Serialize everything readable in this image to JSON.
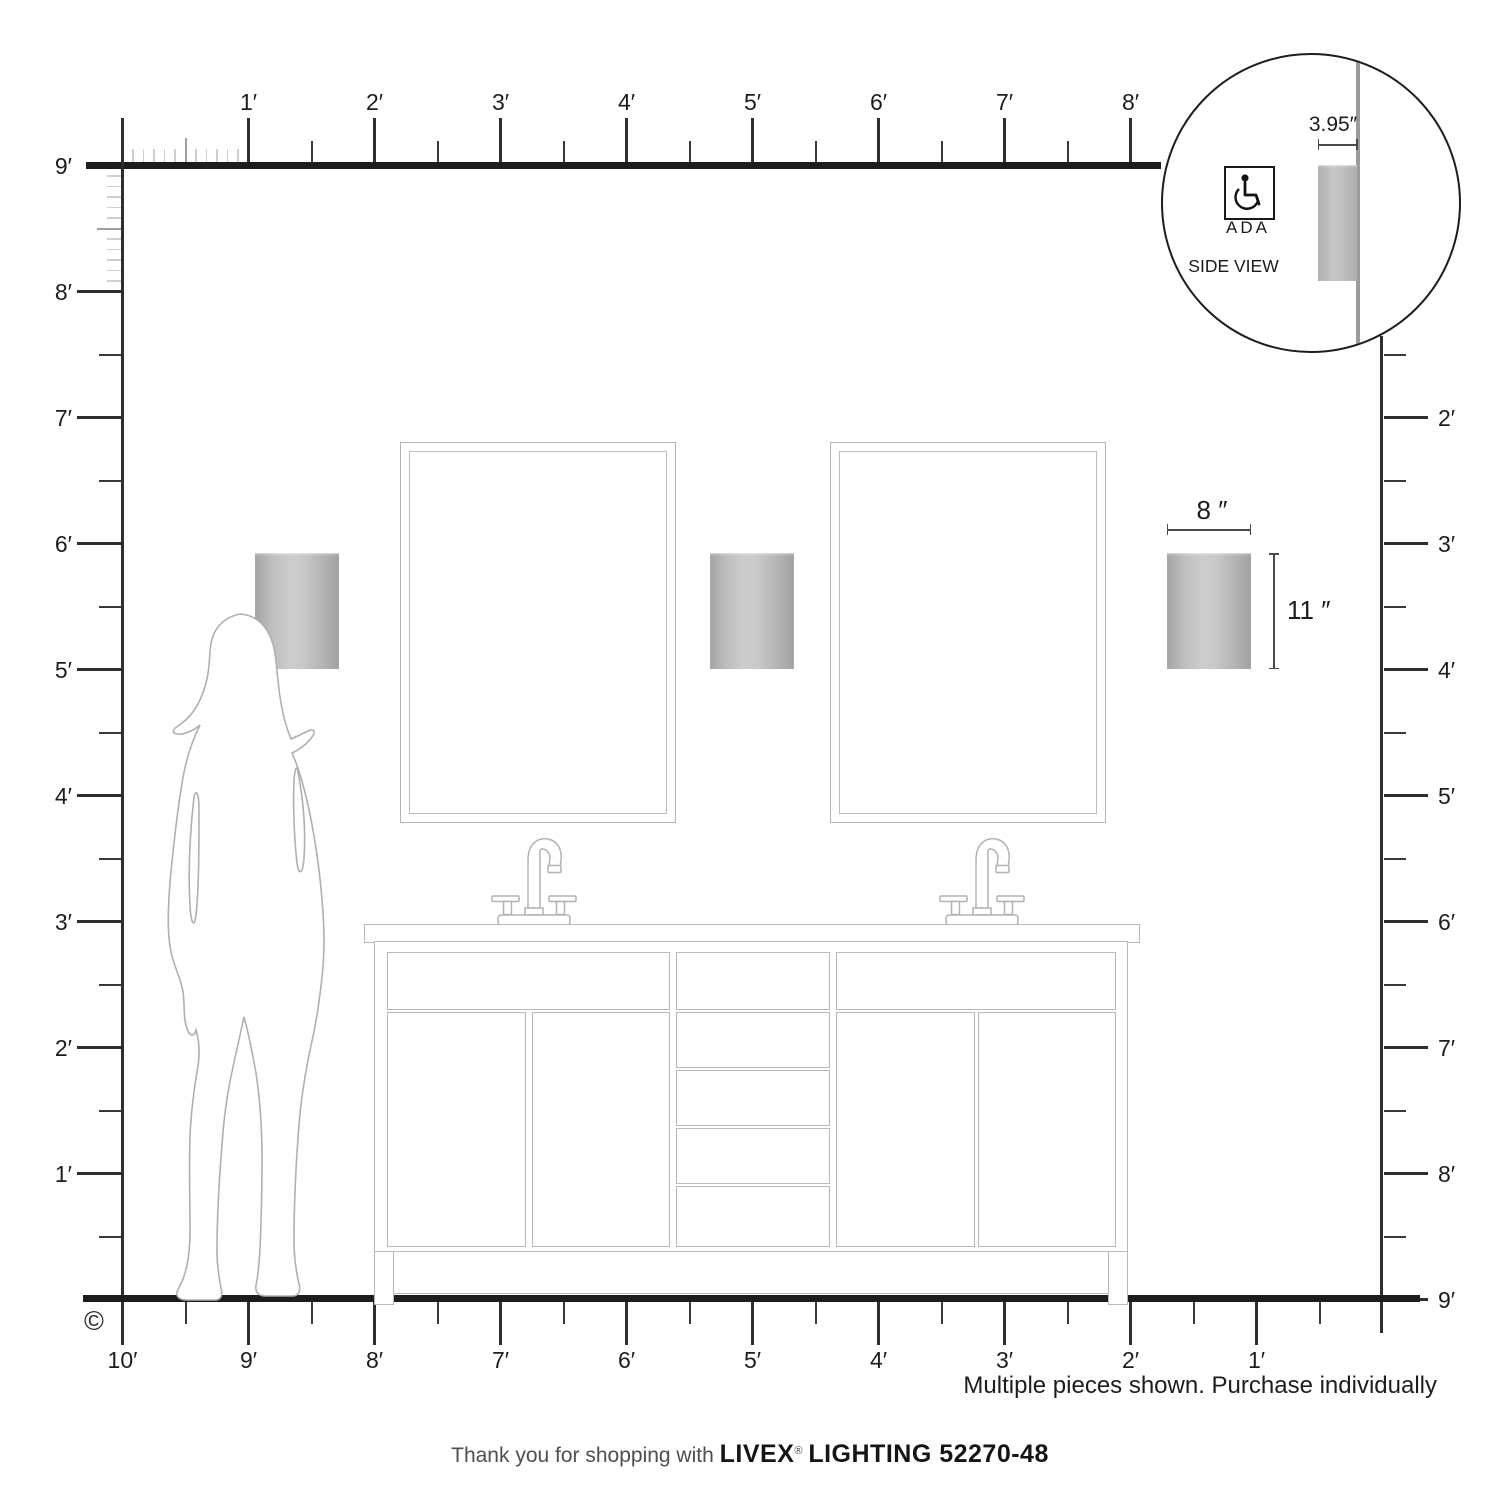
{
  "rulers": {
    "top": {
      "unit": "feet",
      "labels": [
        "1′",
        "2′",
        "3′",
        "4′",
        "5′",
        "6′",
        "7′",
        "8′"
      ]
    },
    "left": {
      "unit": "feet",
      "labels": [
        "9′",
        "8′",
        "7′",
        "6′",
        "5′",
        "4′",
        "3′",
        "2′",
        "1′"
      ]
    },
    "right": {
      "unit": "feet",
      "labels": [
        "2′",
        "3′",
        "4′",
        "5′",
        "6′",
        "7′",
        "8′",
        "9′"
      ]
    },
    "bottom": {
      "unit": "feet",
      "labels": [
        "10′",
        "9′",
        "8′",
        "7′",
        "6′",
        "5′",
        "4′",
        "3′",
        "2′",
        "1′"
      ]
    }
  },
  "fixture": {
    "width_label": "8 ″",
    "height_label": "11 ″"
  },
  "inset": {
    "depth_label": "3.95″",
    "ada_label": "ADA",
    "view_label": "SIDE VIEW"
  },
  "notes": {
    "copyright": "©",
    "purchase_note": "Multiple pieces shown. Purchase individually"
  },
  "footer": {
    "thanks": "Thank you for shopping with",
    "brand": "LIVEX",
    "registered": "®",
    "product": "LIGHTING 52270-48"
  },
  "colors": {
    "ruler": "#1d1d1b",
    "outline": "#b3b3b3",
    "sconce_edge": "#a3a3a3",
    "sconce_center": "#cdcdcd",
    "dimension_line": "#4a4a4a"
  }
}
